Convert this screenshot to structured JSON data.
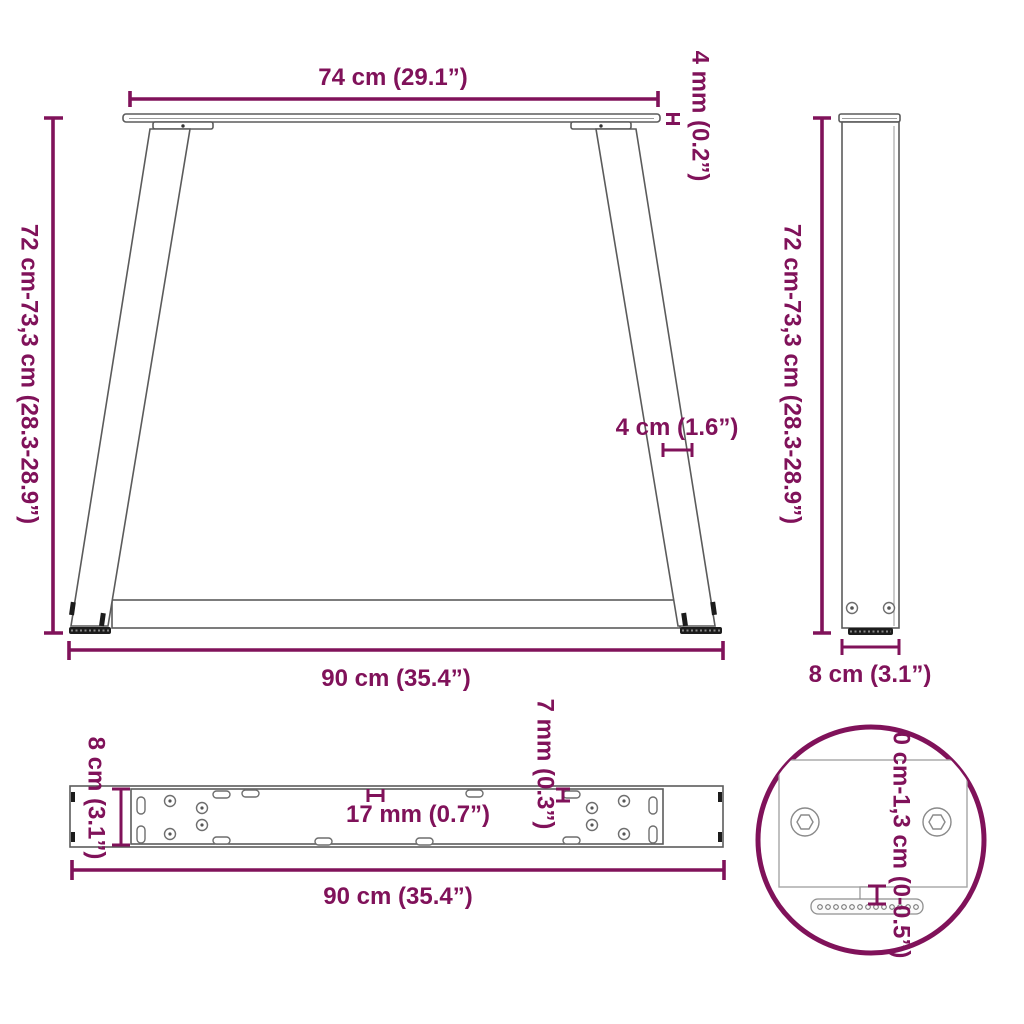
{
  "accent_color": "#80125A",
  "drawing_color": "#5b5b5b",
  "views": {
    "front": {
      "top_width": "74 cm (29.1”)",
      "top_thickness": "4 mm (0.2”)",
      "height": "72 cm-73,3 cm (28.3-28.9”)",
      "leg_width": "4 cm (1.6”)",
      "bottom_width": "90 cm (35.4”)"
    },
    "side": {
      "height": "72 cm-73,3 cm (28.3-28.9”)",
      "depth": "8 cm (3.1”)"
    },
    "top": {
      "depth": "8 cm (3.1”)",
      "slot_length": "17 mm (0.7”)",
      "slot_width": "7 mm (0.3”)",
      "width": "90 cm (35.4”)"
    },
    "detail": {
      "adjustment_range": "0 cm-1,3 cm (0-0.5”)"
    }
  }
}
